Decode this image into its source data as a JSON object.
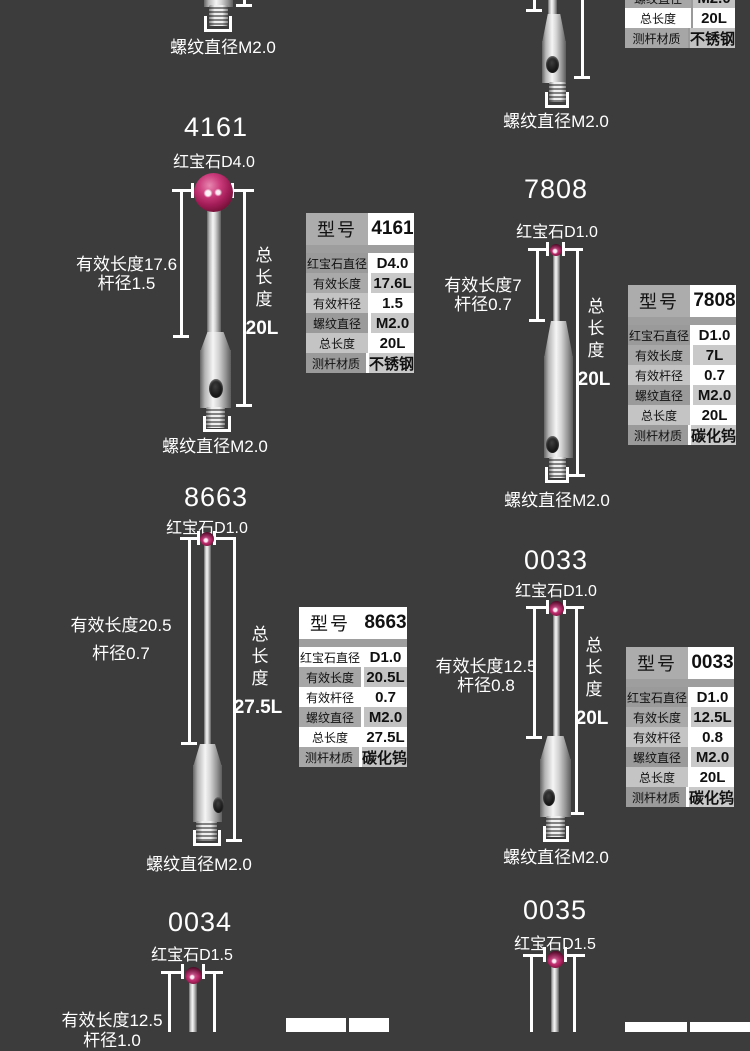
{
  "page": {
    "background": "#3c3c3c"
  },
  "colors": {
    "ruby": "#b02566",
    "dimension_line": "#ffffff",
    "table_gray": "#c9c9c9"
  },
  "top_left_partial": {
    "thread_label": "螺纹直径M2.0"
  },
  "top_right_partial": {
    "thread_label": "螺纹直径M2.0",
    "table": {
      "r4": [
        "螺纹直径",
        "M2.0"
      ],
      "r5": [
        "总长度",
        "20L"
      ],
      "r6": [
        "测杆材质",
        "不锈钢"
      ]
    }
  },
  "s4161": {
    "title": "4161",
    "ruby_label": "红宝石D4.0",
    "left_line1": "有效长度17.6",
    "left_line2": "杆径1.5",
    "total_label": "总长度",
    "total_value": "20L",
    "thread_label": "螺纹直径M2.0",
    "table": {
      "h": [
        "型号",
        "4161"
      ],
      "r1": [
        "红宝石直径",
        "D4.0"
      ],
      "r2": [
        "有效长度",
        "17.6L"
      ],
      "r3": [
        "有效杆径",
        "1.5"
      ],
      "r4": [
        "螺纹直径",
        "M2.0"
      ],
      "r5": [
        "总长度",
        "20L"
      ],
      "r6": [
        "测杆材质",
        "不锈钢"
      ]
    }
  },
  "s7808": {
    "title": "7808",
    "ruby_label": "红宝石D1.0",
    "left_line1": "有效长度7",
    "left_line2": "杆径0.7",
    "total_label": "总长度",
    "total_value": "20L",
    "thread_label": "螺纹直径M2.0",
    "table": {
      "h": [
        "型号",
        "7808"
      ],
      "r1": [
        "红宝石直径",
        "D1.0"
      ],
      "r2": [
        "有效长度",
        "7L"
      ],
      "r3": [
        "有效杆径",
        "0.7"
      ],
      "r4": [
        "螺纹直径",
        "M2.0"
      ],
      "r5": [
        "总长度",
        "20L"
      ],
      "r6": [
        "测杆材质",
        "碳化钨"
      ]
    }
  },
  "s8663": {
    "title": "8663",
    "ruby_label": "红宝石D1.0",
    "left_line1": "有效长度20.5",
    "left_line2": "杆径0.7",
    "total_label": "总长度",
    "total_value": "27.5L",
    "thread_label": "螺纹直径M2.0",
    "table": {
      "h": [
        "型号",
        "8663"
      ],
      "r1": [
        "红宝石直径",
        "D1.0"
      ],
      "r2": [
        "有效长度",
        "20.5L"
      ],
      "r3": [
        "有效杆径",
        "0.7"
      ],
      "r4": [
        "螺纹直径",
        "M2.0"
      ],
      "r5": [
        "总长度",
        "27.5L"
      ],
      "r6": [
        "测杆材质",
        "碳化钨"
      ]
    }
  },
  "s0033": {
    "title": "0033",
    "ruby_label": "红宝石D1.0",
    "left_line1": "有效长度12.5",
    "left_line2": "杆径0.8",
    "total_label": "总长度",
    "total_value": "20L",
    "thread_label": "螺纹直径M2.0",
    "table": {
      "h": [
        "型号",
        "0033"
      ],
      "r1": [
        "红宝石直径",
        "D1.0"
      ],
      "r2": [
        "有效长度",
        "12.5L"
      ],
      "r3": [
        "有效杆径",
        "0.8"
      ],
      "r4": [
        "螺纹直径",
        "M2.0"
      ],
      "r5": [
        "总长度",
        "20L"
      ],
      "r6": [
        "测杆材质",
        "碳化钨"
      ]
    }
  },
  "s0034": {
    "title": "0034",
    "ruby_label": "红宝石D1.5",
    "left_line1": "有效长度12.5",
    "left_line2": "杆径1.0"
  },
  "s0035": {
    "title": "0035",
    "ruby_label": "红宝石D1.5"
  }
}
